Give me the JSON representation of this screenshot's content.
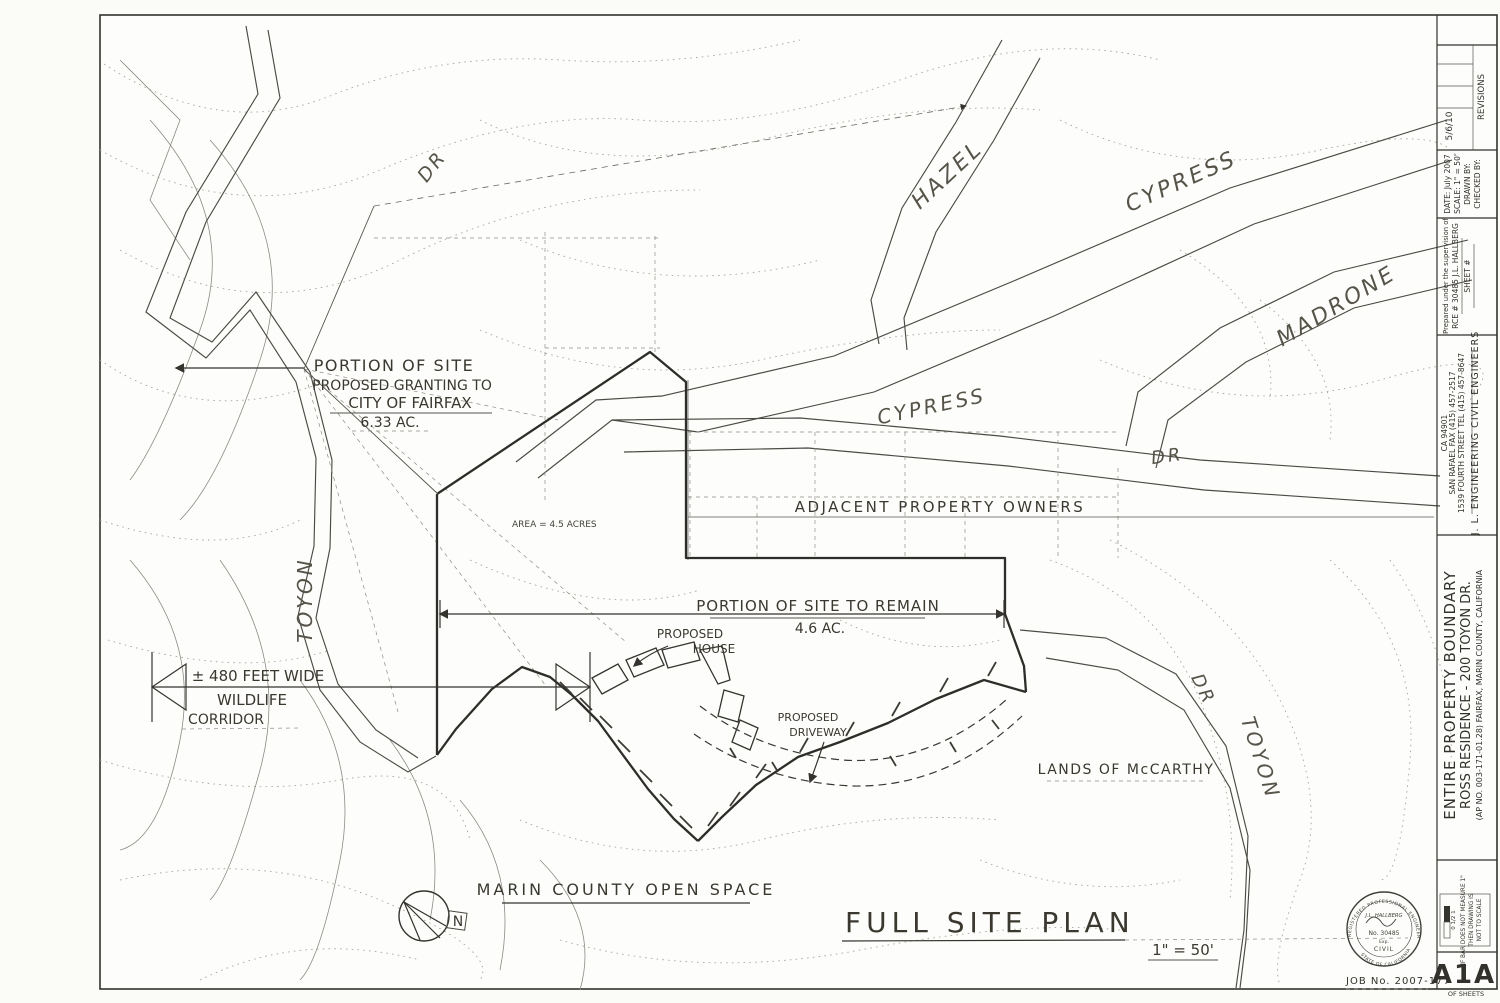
{
  "streets": {
    "dr_topleft": "DR",
    "hazel": "HAZEL",
    "cypress_upper": "CYPRESS",
    "madrone": "MADRONE",
    "cypress_mid": "CYPRESS",
    "dr_mid": "DR",
    "toyon_left": "TOYON",
    "dr_right": "DR",
    "toyon_right": "TOYON"
  },
  "notes": {
    "grant1": "PORTION OF SITE",
    "grant2": "PROPOSED GRANTING TO",
    "grant3": "CITY OF FAIRFAX",
    "grant4": "6.33 AC.",
    "remain1": "PORTION OF SITE TO REMAIN",
    "remain2": "4.6 AC.",
    "wild1": "± 480 FEET WIDE",
    "wild2": "WILDLIFE",
    "wild3": "CORRIDOR",
    "adjacent": "ADJACENT PROPERTY OWNERS",
    "mccarthy": "LANDS OF McCARTHY",
    "openspace": "MARIN COUNTY OPEN SPACE",
    "area": "AREA = 4.5 ACRES",
    "house1": "PROPOSED",
    "house2": "HOUSE",
    "drive1": "PROPOSED",
    "drive2": "DRIVEWAY",
    "north": "N"
  },
  "caption": {
    "title": "FULL SITE PLAN",
    "scale": "1\" = 50'"
  },
  "titleblock": {
    "revisions": {
      "header": "REVISIONS",
      "entry": "5/6/10"
    },
    "info": {
      "date": "DATE:  July 2007",
      "scale": "SCALE:  1\" = 50'",
      "drawn": "DRAWN BY:",
      "checked": "CHECKED BY:"
    },
    "supervision": {
      "l1": "Prepared under the supervision of",
      "l2": "RCE # 30485   J.L. HALLBERG",
      "l3": "SHEET #"
    },
    "firm": {
      "l1": "J. L.  ENGINEERING   CIVIL ENGINEERS",
      "l2": "1539 FOURTH STREET    TEL (415) 457-8647",
      "l3": "SAN RAFAEL    FAX (415) 457-2517",
      "l4": "CA  94901"
    },
    "project": {
      "l1": "ENTIRE PROPERTY BOUNDARY",
      "l2": "ROSS RESIDENCE - 200 TOYON DR.",
      "l3": "(AP NO. 003-171-01.28)   FAIRFAX,   MARIN COUNTY,   CALIFORNIA"
    },
    "scalebar": {
      "ticks": "0   1/2   1",
      "note1": "IF BAR DOES NOT MEASURE 1\"",
      "note2": "THEN DRAWING IS",
      "note3": "NOT TO SCALE"
    },
    "sheet": {
      "number": "A1A",
      "of": "OF        SHEETS"
    },
    "job": "JOB No.  2007-177",
    "seal": {
      "top": "REGISTERED PROFESSIONAL ENGINEER",
      "name": "J.L. HALLBERG",
      "no": "No. 30485",
      "exp": "Exp.",
      "civil": "CIVIL",
      "bottom": "STATE OF CALIFORNIA"
    }
  }
}
